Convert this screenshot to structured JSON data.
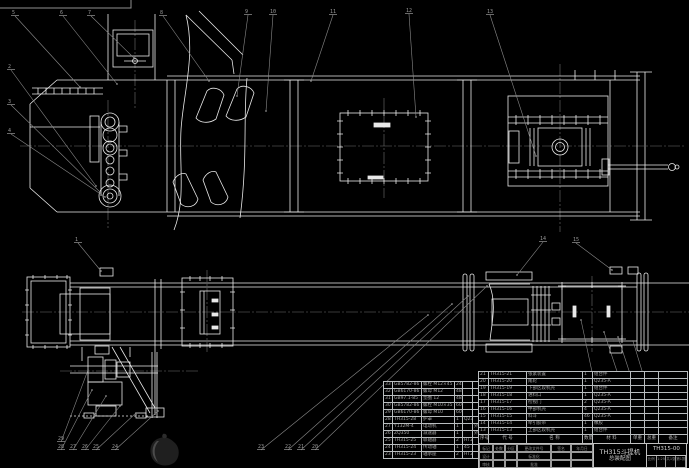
{
  "colors": {
    "background": "#000000",
    "line": "#e9e9e9",
    "dim_gray": "#8a8a8a",
    "table_text": "#a6a6a6",
    "title_text": "#d2d2d2"
  },
  "title_block": {
    "product": "TH315斗提机",
    "doc_type": "总装配图",
    "drawing_no": "TH315-00",
    "footer_cells": [
      "比例",
      "1:25",
      "共1张",
      "第1张"
    ],
    "sig_rows": [
      [
        "标记",
        "处数",
        "分区",
        "更改文件号",
        "签名",
        "年月日"
      ],
      [
        "设计",
        "",
        "",
        "标准化",
        "",
        ""
      ],
      [
        "审核",
        "",
        "",
        "批准",
        "",
        ""
      ]
    ]
  },
  "bom": {
    "header": [
      "序号",
      "代  号",
      "名  称",
      "数量",
      "材  料",
      "单重",
      "总重",
      "备注"
    ],
    "right_rows": [
      [
        "21",
        "TH315-21",
        "张紧装置",
        "1",
        "组合件",
        "",
        "",
        ""
      ],
      [
        "20",
        "TH315-20",
        "尾轮",
        "1",
        "Q235-A",
        "",
        "",
        ""
      ],
      [
        "19",
        "TH315-19",
        "下部区段机壳",
        "1",
        "组合件",
        "",
        "",
        ""
      ],
      [
        "18",
        "TH315-18",
        "进料口",
        "1",
        "Q235-A",
        "",
        "",
        ""
      ],
      [
        "17",
        "TH315-17",
        "检视门",
        "2",
        "Q235-A",
        "",
        "",
        ""
      ],
      [
        "16",
        "TH315-16",
        "中部机壳",
        "4",
        "Q235-A",
        "",
        "",
        ""
      ],
      [
        "15",
        "TH315-15",
        "料斗",
        "46",
        "Q235-A",
        "",
        "",
        ""
      ],
      [
        "14",
        "TH315-14",
        "牵引胶带",
        "1",
        "橡胶",
        "",
        "",
        ""
      ],
      [
        "13",
        "TH315-13",
        "上部区段机壳",
        "1",
        "组合件",
        "",
        "",
        ""
      ]
    ],
    "left_rows": [
      [
        "33",
        "GB5782-86",
        "螺栓 M12×45",
        "24",
        "",
        ""
      ],
      [
        "32",
        "GB6170-86",
        "螺母 M12",
        "48",
        "",
        ""
      ],
      [
        "31",
        "GB97.1-85",
        "垫圈 12",
        "48",
        "",
        ""
      ],
      [
        "30",
        "GB5782-86",
        "螺栓 M10×35",
        "60",
        "",
        ""
      ],
      [
        "29",
        "GB6170-86",
        "螺母 M10",
        "60",
        "",
        ""
      ],
      [
        "28",
        "TH315-28",
        "护罩",
        "1",
        "Q235-A",
        ""
      ],
      [
        "27",
        "Y132M-4",
        "电动机",
        "1",
        "",
        "外购"
      ],
      [
        "26",
        "ZQ350",
        "减速器",
        "1",
        "",
        "外购"
      ],
      [
        "25",
        "TH315-25",
        "联轴器",
        "2",
        "HT200",
        ""
      ],
      [
        "24",
        "TH315-24",
        "传动轴",
        "1",
        "45",
        ""
      ],
      [
        "23",
        "TH315-23",
        "轴承座",
        "2",
        "HT200",
        ""
      ]
    ]
  },
  "balloons": [
    {
      "n": "5",
      "x": 12,
      "y": 10,
      "tx": 80,
      "ty": 87
    },
    {
      "n": "6",
      "x": 60,
      "y": 10,
      "tx": 117,
      "ty": 84
    },
    {
      "n": "7",
      "x": 88,
      "y": 10,
      "tx": 134,
      "ty": 58
    },
    {
      "n": "8",
      "x": 160,
      "y": 10,
      "tx": 209,
      "ty": 81
    },
    {
      "n": "9",
      "x": 245,
      "y": 9,
      "tx": 237,
      "ty": 96
    },
    {
      "n": "10",
      "x": 270,
      "y": 9,
      "tx": 266,
      "ty": 111
    },
    {
      "n": "11",
      "x": 330,
      "y": 9,
      "tx": 311,
      "ty": 81
    },
    {
      "n": "12",
      "x": 406,
      "y": 8,
      "tx": 416,
      "ty": 117
    },
    {
      "n": "13",
      "x": 487,
      "y": 9,
      "tx": 536,
      "ty": 156
    },
    {
      "n": "2",
      "x": 8,
      "y": 64,
      "tx": 96,
      "ty": 186
    },
    {
      "n": "3",
      "x": 8,
      "y": 99,
      "tx": 100,
      "ty": 192
    },
    {
      "n": "4",
      "x": 8,
      "y": 128,
      "tx": 105,
      "ty": 197
    },
    {
      "n": "1",
      "x": 75,
      "y": 237,
      "tx": 101,
      "ty": 271
    },
    {
      "n": "14",
      "x": 540,
      "y": 236,
      "tx": 517,
      "ty": 275
    },
    {
      "n": "15",
      "x": 573,
      "y": 237,
      "tx": 612,
      "ty": 270
    },
    {
      "n": "16",
      "x": 605,
      "y": 441,
      "tx": 581,
      "ty": 320
    },
    {
      "n": "17",
      "x": 640,
      "y": 444,
      "tx": 604,
      "ty": 332
    },
    {
      "n": "18",
      "x": 652,
      "y": 444,
      "tx": 618,
      "ty": 337
    },
    {
      "n": "19",
      "x": 663,
      "y": 444,
      "tx": 633,
      "ty": 341
    },
    {
      "n": "20",
      "x": 312,
      "y": 444,
      "tx": 487,
      "ty": 286
    },
    {
      "n": "21",
      "x": 298,
      "y": 444,
      "tx": 468,
      "ty": 296
    },
    {
      "n": "22",
      "x": 285,
      "y": 444,
      "tx": 452,
      "ty": 304
    },
    {
      "n": "23",
      "x": 258,
      "y": 444,
      "tx": 428,
      "ty": 315
    },
    {
      "n": "24",
      "x": 112,
      "y": 444,
      "tx": 158,
      "ty": 411
    },
    {
      "n": "25",
      "x": 93,
      "y": 444,
      "tx": 136,
      "ty": 413
    },
    {
      "n": "26",
      "x": 82,
      "y": 444,
      "tx": 120,
      "ty": 406
    },
    {
      "n": "27",
      "x": 70,
      "y": 444,
      "tx": 106,
      "ty": 396
    },
    {
      "n": "28",
      "x": 58,
      "y": 444,
      "tx": 92,
      "ty": 390
    },
    {
      "n": "29",
      "x": 58,
      "y": 436,
      "tx": 88,
      "ty": 370
    }
  ]
}
